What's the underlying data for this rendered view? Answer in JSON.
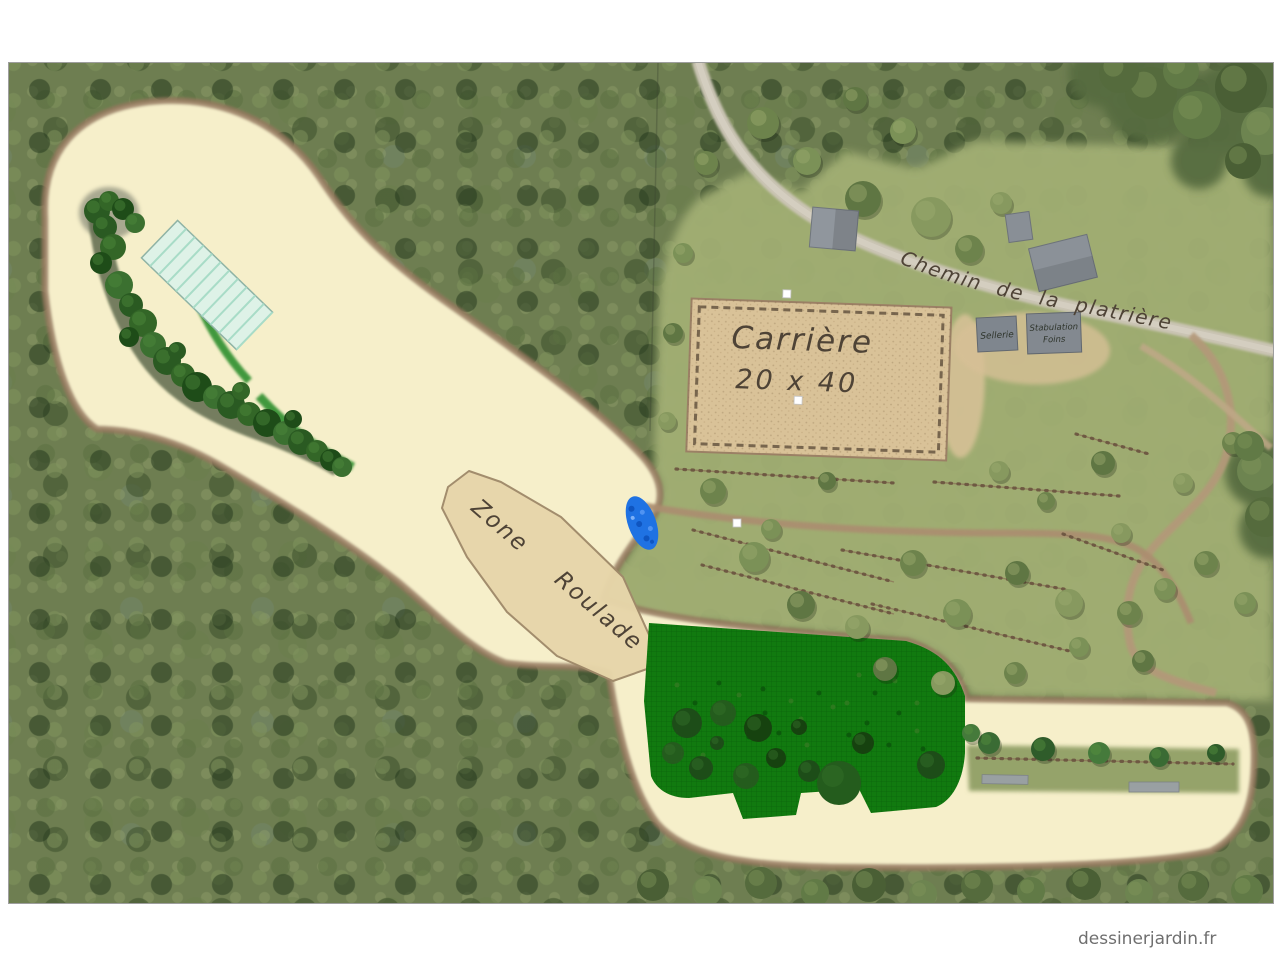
{
  "watermark": "dessinerjardin.fr",
  "map": {
    "arena": {
      "title": "Carrière",
      "size": "20 x 40"
    },
    "zone_label": "Zone Roulade",
    "road_label": "Chemin de la platrière",
    "buildings": {
      "tack_room": "Sellerie",
      "stable_line1": "Stabulation",
      "stable_line2": "Foins"
    },
    "colors": {
      "cream_track": "#f6efca",
      "dirt_edge": "#96785e",
      "arena_sand": "#d9c298",
      "pasture_green": "#117a0f",
      "pond_blue": "#1f72e3",
      "meadow_green": "#a1ae73",
      "road_grey": "#cac4b4",
      "shelter_teal_fill": "#def2e7",
      "shelter_teal_stripe": "#a8dcc7",
      "handwriting": "#4e4336"
    }
  }
}
